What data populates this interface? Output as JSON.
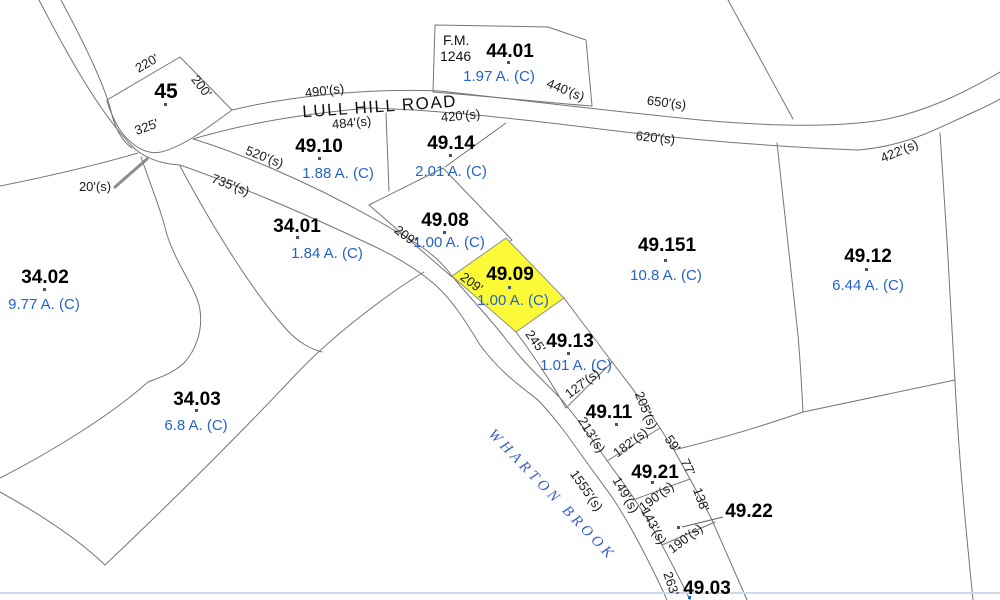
{
  "map": {
    "road_name": "LULL HILL ROAD",
    "brook_name": "WHARTON BROOK",
    "fm": {
      "line1": "F.M.",
      "line2": "1246"
    },
    "colors": {
      "highlight": "#FCF937",
      "acreage_text": "#2563C9",
      "parcel_line": "#757575",
      "brook_text": "#3A5FC8"
    },
    "parcels": [
      {
        "id": "45",
        "acreage": ""
      },
      {
        "id": "44.01",
        "acreage": "1.97 A. (C)"
      },
      {
        "id": "49.10",
        "acreage": "1.88 A. (C)"
      },
      {
        "id": "49.14",
        "acreage": "2.01 A. (C)"
      },
      {
        "id": "49.08",
        "acreage": "1.00 A. (C)"
      },
      {
        "id": "49.09",
        "acreage": "1.00 A. (C)",
        "highlighted": true
      },
      {
        "id": "49.13",
        "acreage": "1.01 A. (C)"
      },
      {
        "id": "49.11",
        "acreage": ""
      },
      {
        "id": "49.21",
        "acreage": ""
      },
      {
        "id": "49.22",
        "acreage": ""
      },
      {
        "id": "49.03",
        "acreage": ""
      },
      {
        "id": "49.151",
        "acreage": "10.8 A. (C)"
      },
      {
        "id": "49.12",
        "acreage": "6.44 A. (C)"
      },
      {
        "id": "34.01",
        "acreage": "1.84 A. (C)"
      },
      {
        "id": "34.02",
        "acreage": "9.77 A. (C)"
      },
      {
        "id": "34.03",
        "acreage": "6.8 A. (C)"
      }
    ],
    "dimensions": [
      "220'",
      "200'",
      "325'",
      "20'(s)",
      "490'(s)",
      "484'(s)",
      "420'(s)",
      "440'(s)",
      "650'(s)",
      "620'(s)",
      "422'(s)",
      "520'(s)",
      "735'(s)",
      "209'",
      "209'",
      "245'",
      "1555'(s)",
      "127'(s)",
      "213'(s)",
      "205'(s)",
      "182'(s)",
      "59'",
      "77'",
      "149'(s)",
      "190'(s)",
      "138'",
      "143'(s)",
      "190'(s)",
      "263'"
    ]
  }
}
